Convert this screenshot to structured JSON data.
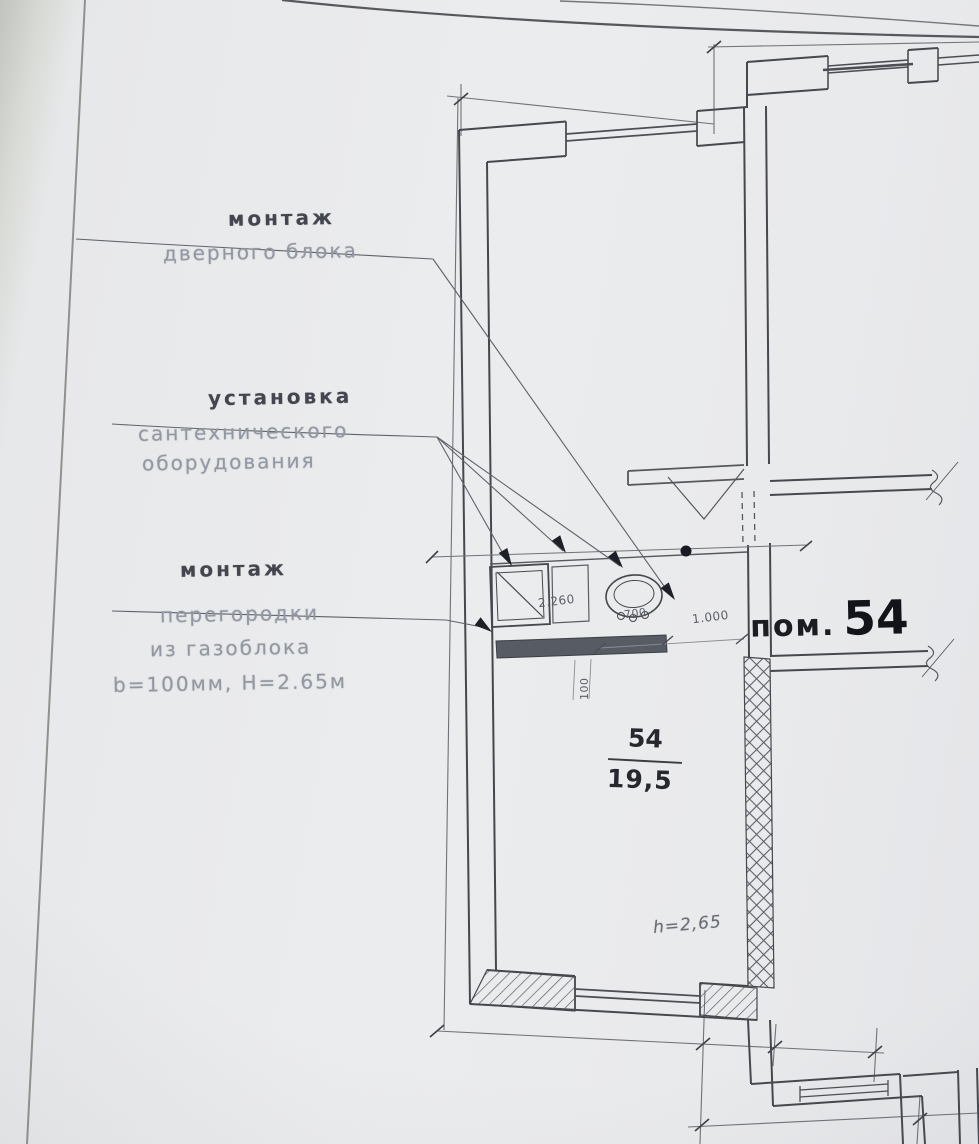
{
  "labels": {
    "door": {
      "title": "монтаж",
      "line1": "дверного блока"
    },
    "sanitary": {
      "title": "установка",
      "line1": "сантехнического",
      "line2": "оборудования"
    },
    "partition": {
      "title": "монтаж",
      "line1": "перегородки",
      "line2": "из газоблока",
      "line3": "b=100мм, H=2.65м"
    }
  },
  "room": {
    "label_prefix": "пом.",
    "label_number": "54",
    "number": "54",
    "area": "19,5",
    "height": "h=2,65"
  },
  "dims": {
    "partition_run": "2.260",
    "run_700": "700",
    "door_width": "1.000",
    "thickness": "100"
  },
  "colors": {
    "paper": "#e9eaec",
    "line": "#45484e",
    "light_text": "#9298a2",
    "dark_text": "#121419",
    "new_partition_fill": "#565b64"
  }
}
